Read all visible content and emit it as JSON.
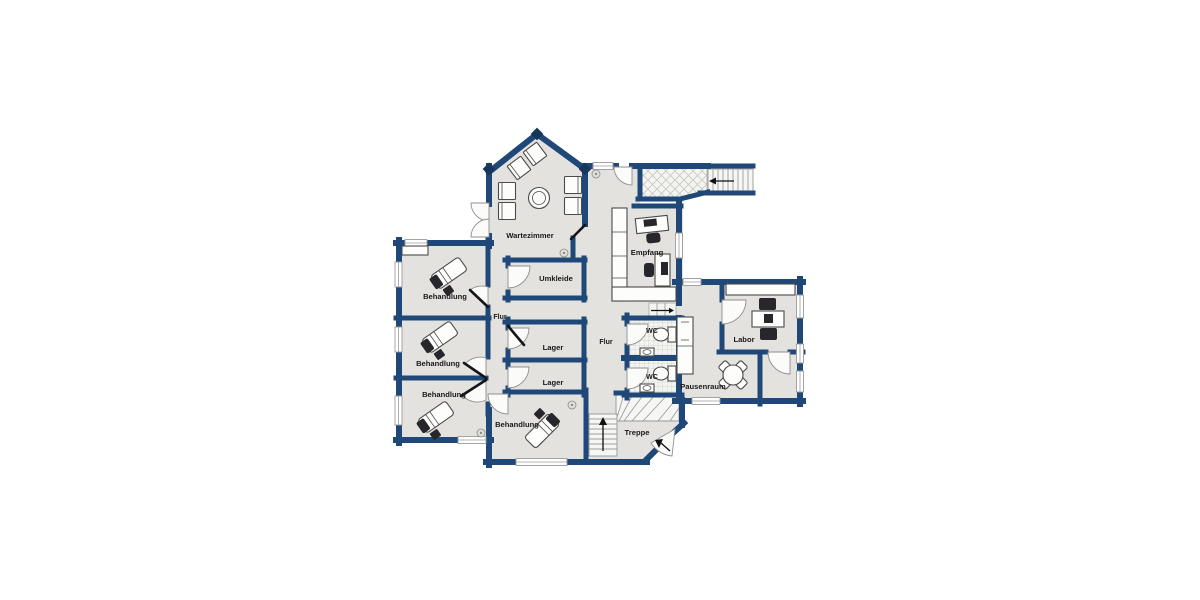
{
  "plan": {
    "type": "architectural-floor-plan",
    "colors": {
      "wall": "#1f4878",
      "wall_joint": "#17365c",
      "floor": "#e3e2df",
      "tile_background": "#f4f4f1",
      "tile_line": "#c7c7c3",
      "furniture_dark": "#27272b",
      "label_text": "#18181c",
      "background": "#ffffff"
    },
    "rooms": [
      {
        "id": "wartezimmer",
        "label": "Wartezimmer"
      },
      {
        "id": "umkleide",
        "label": "Umkleide"
      },
      {
        "id": "empfang",
        "label": "Empfang"
      },
      {
        "id": "behandlung-1",
        "label": "Behandlung"
      },
      {
        "id": "behandlung-2",
        "label": "Behandlung"
      },
      {
        "id": "behandlung-3",
        "label": "Behandlung"
      },
      {
        "id": "behandlung-4",
        "label": "Behandlung"
      },
      {
        "id": "lager-1",
        "label": "Lager"
      },
      {
        "id": "lager-2",
        "label": "Lager"
      },
      {
        "id": "flur-1",
        "label": "Flur"
      },
      {
        "id": "flur-2",
        "label": "Flur"
      },
      {
        "id": "wc-1",
        "label": "WC"
      },
      {
        "id": "wc-2",
        "label": "WC"
      },
      {
        "id": "labor",
        "label": "Labor"
      },
      {
        "id": "pausenraum",
        "label": "Pausenraum"
      },
      {
        "id": "treppe",
        "label": "Treppe"
      }
    ]
  }
}
